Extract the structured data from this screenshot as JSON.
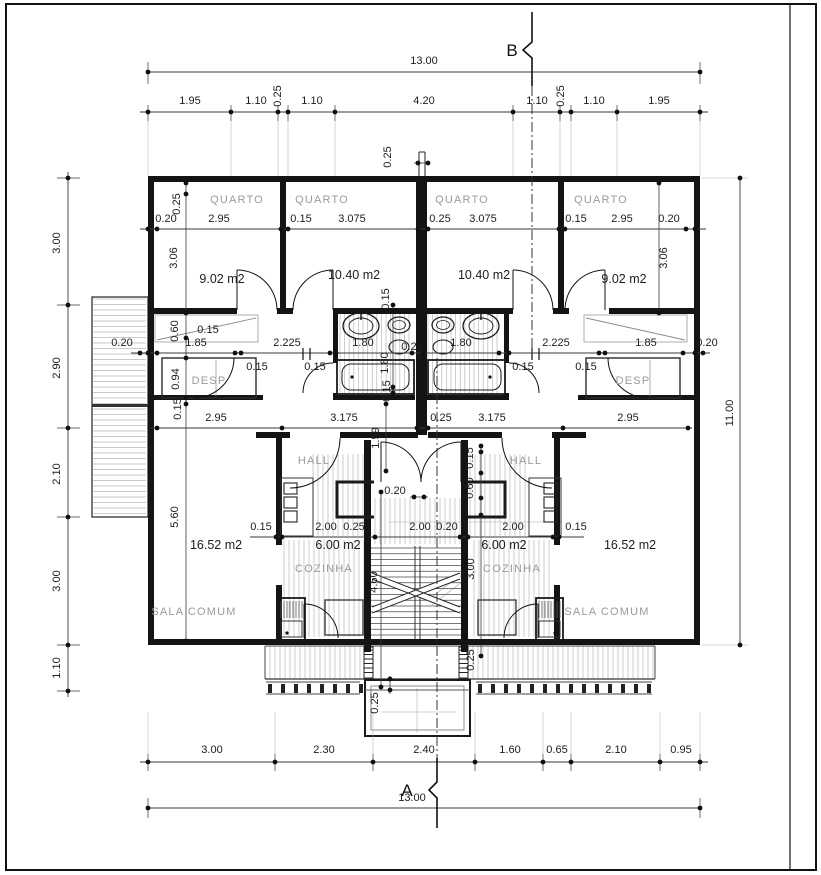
{
  "sheet": {
    "type": "architectural-floor-plan",
    "units": "m",
    "overall_width": "13.00",
    "overall_height": "11.00"
  },
  "colors": {
    "wall": "#141414",
    "dim_line": "#3a3a3a",
    "room_label": "#9a9a9a",
    "hatch": "#b9b9b9",
    "window": "#b2b2b2",
    "construction": "#c3c3c3",
    "background": "#ffffff"
  },
  "section_markers": [
    {
      "label": "B",
      "x": 512,
      "y": 56
    },
    {
      "label": "A",
      "x": 407,
      "y": 796
    }
  ],
  "room_labels": [
    {
      "t": "QUARTO",
      "x": 237,
      "y": 203
    },
    {
      "t": "QUARTO",
      "x": 322,
      "y": 203
    },
    {
      "t": "QUARTO",
      "x": 462,
      "y": 203
    },
    {
      "t": "QUARTO",
      "x": 601,
      "y": 203
    },
    {
      "t": "DESP",
      "x": 209,
      "y": 384
    },
    {
      "t": "DESP",
      "x": 633,
      "y": 384
    },
    {
      "t": "HALL",
      "x": 314,
      "y": 464
    },
    {
      "t": "HALL",
      "x": 526,
      "y": 464
    },
    {
      "t": "COZINHA",
      "x": 324,
      "y": 572
    },
    {
      "t": "COZINHA",
      "x": 512,
      "y": 572
    },
    {
      "t": "SALA COMUM",
      "x": 194,
      "y": 615
    },
    {
      "t": "SALA COMUM",
      "x": 607,
      "y": 615
    }
  ],
  "area_labels": [
    {
      "t": "9.02 m2",
      "x": 222,
      "y": 283
    },
    {
      "t": "10.40 m2",
      "x": 354,
      "y": 279
    },
    {
      "t": "10.40 m2",
      "x": 484,
      "y": 279
    },
    {
      "t": "9.02 m2",
      "x": 624,
      "y": 283
    },
    {
      "t": "16.52 m2",
      "x": 216,
      "y": 549
    },
    {
      "t": "6.00 m2",
      "x": 338,
      "y": 549
    },
    {
      "t": "6.00 m2",
      "x": 504,
      "y": 549
    },
    {
      "t": "16.52 m2",
      "x": 630,
      "y": 549
    }
  ],
  "dim_labels": [
    {
      "t": "13.00",
      "x": 424,
      "y": 64
    },
    {
      "t": "1.95",
      "x": 190,
      "y": 104
    },
    {
      "t": "1.10",
      "x": 256,
      "y": 104
    },
    {
      "t": "0.25",
      "x": 281,
      "y": 96,
      "r": 1
    },
    {
      "t": "1.10",
      "x": 312,
      "y": 104
    },
    {
      "t": "4.20",
      "x": 424,
      "y": 104
    },
    {
      "t": "1.10",
      "x": 537,
      "y": 104
    },
    {
      "t": "0.25",
      "x": 564,
      "y": 96,
      "r": 1
    },
    {
      "t": "1.10",
      "x": 594,
      "y": 104
    },
    {
      "t": "1.95",
      "x": 659,
      "y": 104
    },
    {
      "t": "0.25",
      "x": 391,
      "y": 157,
      "r": 1
    },
    {
      "t": "0.25",
      "x": 180,
      "y": 204,
      "r": 1
    },
    {
      "t": "0.20",
      "x": 166,
      "y": 222
    },
    {
      "t": "2.95",
      "x": 219,
      "y": 222
    },
    {
      "t": "0.15",
      "x": 301,
      "y": 222
    },
    {
      "t": "3.075",
      "x": 352,
      "y": 222
    },
    {
      "t": "0.25",
      "x": 440,
      "y": 222
    },
    {
      "t": "3.075",
      "x": 483,
      "y": 222
    },
    {
      "t": "0.15",
      "x": 576,
      "y": 222
    },
    {
      "t": "2.95",
      "x": 622,
      "y": 222
    },
    {
      "t": "0.20",
      "x": 669,
      "y": 222
    },
    {
      "t": "3.06",
      "x": 177,
      "y": 258,
      "r": 1
    },
    {
      "t": "3.06",
      "x": 667,
      "y": 258,
      "r": 1
    },
    {
      "t": "0.15",
      "x": 389,
      "y": 299,
      "r": 1
    },
    {
      "t": "0.60",
      "x": 178,
      "y": 331,
      "r": 1
    },
    {
      "t": "0.15",
      "x": 208,
      "y": 333
    },
    {
      "t": "0.20",
      "x": 122,
      "y": 346
    },
    {
      "t": "1.85",
      "x": 196,
      "y": 346
    },
    {
      "t": "2.225",
      "x": 287,
      "y": 346
    },
    {
      "t": "1.80",
      "x": 363,
      "y": 346
    },
    {
      "t": "0.25",
      "x": 412,
      "y": 350
    },
    {
      "t": "1.80",
      "x": 388,
      "y": 363,
      "r": 1
    },
    {
      "t": "1.80",
      "x": 461,
      "y": 346
    },
    {
      "t": "2.225",
      "x": 556,
      "y": 346
    },
    {
      "t": "1.85",
      "x": 646,
      "y": 346
    },
    {
      "t": "0.20",
      "x": 707,
      "y": 346
    },
    {
      "t": "0.94",
      "x": 179,
      "y": 379,
      "r": 1
    },
    {
      "t": "0.15",
      "x": 257,
      "y": 370
    },
    {
      "t": "0.15",
      "x": 315,
      "y": 370
    },
    {
      "t": "0.15",
      "x": 523,
      "y": 370
    },
    {
      "t": "0.15",
      "x": 586,
      "y": 370
    },
    {
      "t": "0.15",
      "x": 390,
      "y": 391,
      "r": 1
    },
    {
      "t": "0.15",
      "x": 181,
      "y": 409,
      "r": 1
    },
    {
      "t": "2.95",
      "x": 216,
      "y": 421
    },
    {
      "t": "3.175",
      "x": 344,
      "y": 421
    },
    {
      "t": "0.25",
      "x": 441,
      "y": 421
    },
    {
      "t": "3.175",
      "x": 492,
      "y": 421
    },
    {
      "t": "2.95",
      "x": 628,
      "y": 421
    },
    {
      "t": "1.59",
      "x": 379,
      "y": 438,
      "r": 1
    },
    {
      "t": "0.15",
      "x": 473,
      "y": 458,
      "r": 1
    },
    {
      "t": "0.60",
      "x": 473,
      "y": 488,
      "r": 1
    },
    {
      "t": "0.20",
      "x": 395,
      "y": 494
    },
    {
      "t": "5.60",
      "x": 178,
      "y": 517,
      "r": 1
    },
    {
      "t": "0.15",
      "x": 261,
      "y": 530
    },
    {
      "t": "2.00",
      "x": 326,
      "y": 530
    },
    {
      "t": "0.25",
      "x": 354,
      "y": 530
    },
    {
      "t": "2.00",
      "x": 420,
      "y": 530
    },
    {
      "t": "0.20",
      "x": 447,
      "y": 530
    },
    {
      "t": "2.00",
      "x": 513,
      "y": 530
    },
    {
      "t": "0.15",
      "x": 576,
      "y": 530
    },
    {
      "t": "3.00",
      "x": 474,
      "y": 569,
      "r": 1
    },
    {
      "t": "4.60",
      "x": 377,
      "y": 582,
      "r": 1
    },
    {
      "t": "0.25",
      "x": 474,
      "y": 660,
      "r": 1
    },
    {
      "t": "0.25",
      "x": 378,
      "y": 703,
      "r": 1
    },
    {
      "t": "3.00",
      "x": 60,
      "y": 243,
      "r": 1
    },
    {
      "t": "2.90",
      "x": 60,
      "y": 368,
      "r": 1
    },
    {
      "t": "2.10",
      "x": 60,
      "y": 474,
      "r": 1
    },
    {
      "t": "3.00",
      "x": 60,
      "y": 581,
      "r": 1
    },
    {
      "t": "1.10",
      "x": 60,
      "y": 668,
      "r": 1
    },
    {
      "t": "11.00",
      "x": 733,
      "y": 413,
      "r": 1
    },
    {
      "t": "3.00",
      "x": 212,
      "y": 753
    },
    {
      "t": "2.30",
      "x": 324,
      "y": 753
    },
    {
      "t": "2.40",
      "x": 424,
      "y": 753
    },
    {
      "t": "1.60",
      "x": 510,
      "y": 753
    },
    {
      "t": "0.65",
      "x": 557,
      "y": 753
    },
    {
      "t": "2.10",
      "x": 616,
      "y": 753
    },
    {
      "t": "0.95",
      "x": 681,
      "y": 753
    },
    {
      "t": "13.00",
      "x": 412,
      "y": 801
    }
  ]
}
